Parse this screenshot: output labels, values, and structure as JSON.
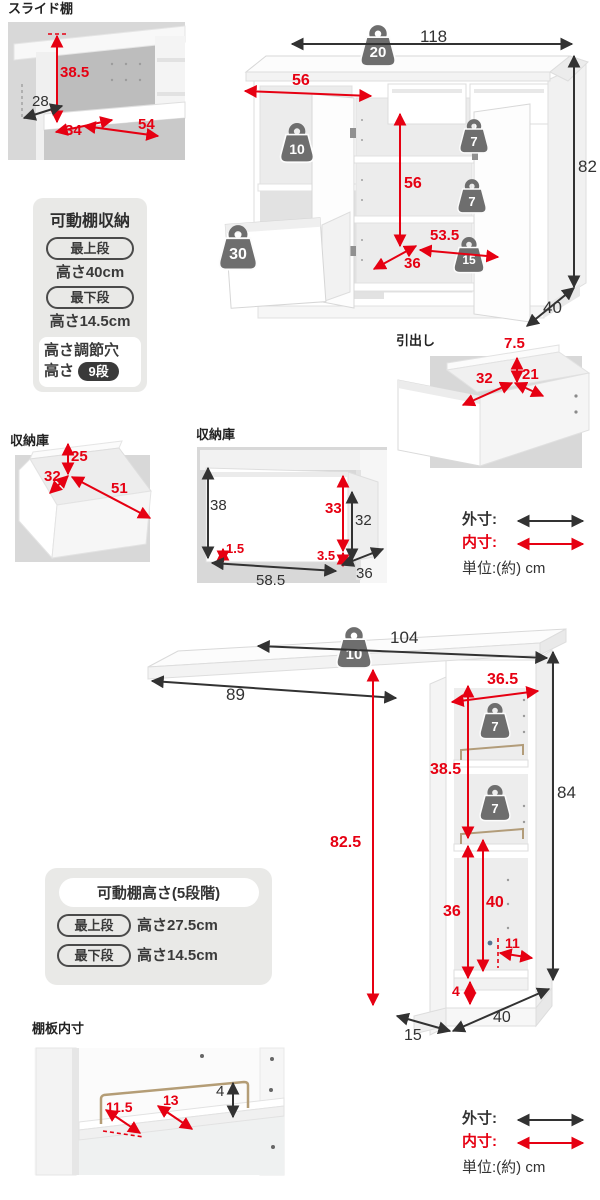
{
  "colors": {
    "outer_dim": "#323232",
    "inner_dim": "#e60012",
    "weight_icon": "#6e6e6e",
    "photo_bg": "#d8d8d8",
    "panel_bg": "#e9e9e7"
  },
  "legend": {
    "outer": "外寸:",
    "inner": "内寸:",
    "unit": "単位:(約) cm"
  },
  "top": {
    "slide_shelf": {
      "title": "スライド棚",
      "height": "38.5",
      "front": "28",
      "depth": "34",
      "width": "54"
    },
    "cabinet": {
      "width": "118",
      "height": "82",
      "depth": "40",
      "open_width": "56",
      "door_height": "56",
      "inner_width": "53.5",
      "inner_depth": "36",
      "weight_top": "20",
      "weight_open": "10",
      "weight_shelf1": "7",
      "weight_shelf2": "7",
      "weight_bottom": "15",
      "weight_drawer": "30"
    },
    "shelf_box": {
      "title": "可動棚収納",
      "row1_pill": "最上段",
      "row1_text": "高さ40cm",
      "row2_pill": "最下段",
      "row2_text": "高さ14.5cm",
      "holes_title": "高さ調節穴",
      "holes_label": "高さ",
      "holes_badge": "9段"
    },
    "drawer": {
      "title": "引出し",
      "height": "7.5",
      "width": "32",
      "depth": "21"
    },
    "storage1": {
      "title": "収納庫",
      "height": "25",
      "width": "32",
      "depth": "51"
    },
    "storage2": {
      "title": "収納庫",
      "front_height": "38",
      "bottom_gap": "1.5",
      "width": "58.5",
      "inner_height": "33",
      "side_gap": "3.5",
      "side_height": "32",
      "depth": "36"
    }
  },
  "bottom": {
    "counter": {
      "width": "104",
      "overhang": "89",
      "height": "84",
      "depth": "40",
      "front_depth": "15",
      "top_width": "36.5",
      "shelf_pitch": "38.5",
      "under_height": "82.5",
      "open_height": "36",
      "open_full": "40",
      "base_depth": "11",
      "base_height": "4",
      "weight_top": "10",
      "weight_shelf1": "7",
      "weight_shelf2": "7"
    },
    "shelf_box": {
      "header": "可動棚高さ(5段階)",
      "row1_pill": "最上段",
      "row1_text": "高さ27.5cm",
      "row2_pill": "最下段",
      "row2_text": "高さ14.5cm"
    },
    "board": {
      "title": "棚板内寸",
      "inner1": "11.5",
      "inner2": "13",
      "rail_height": "4"
    }
  }
}
